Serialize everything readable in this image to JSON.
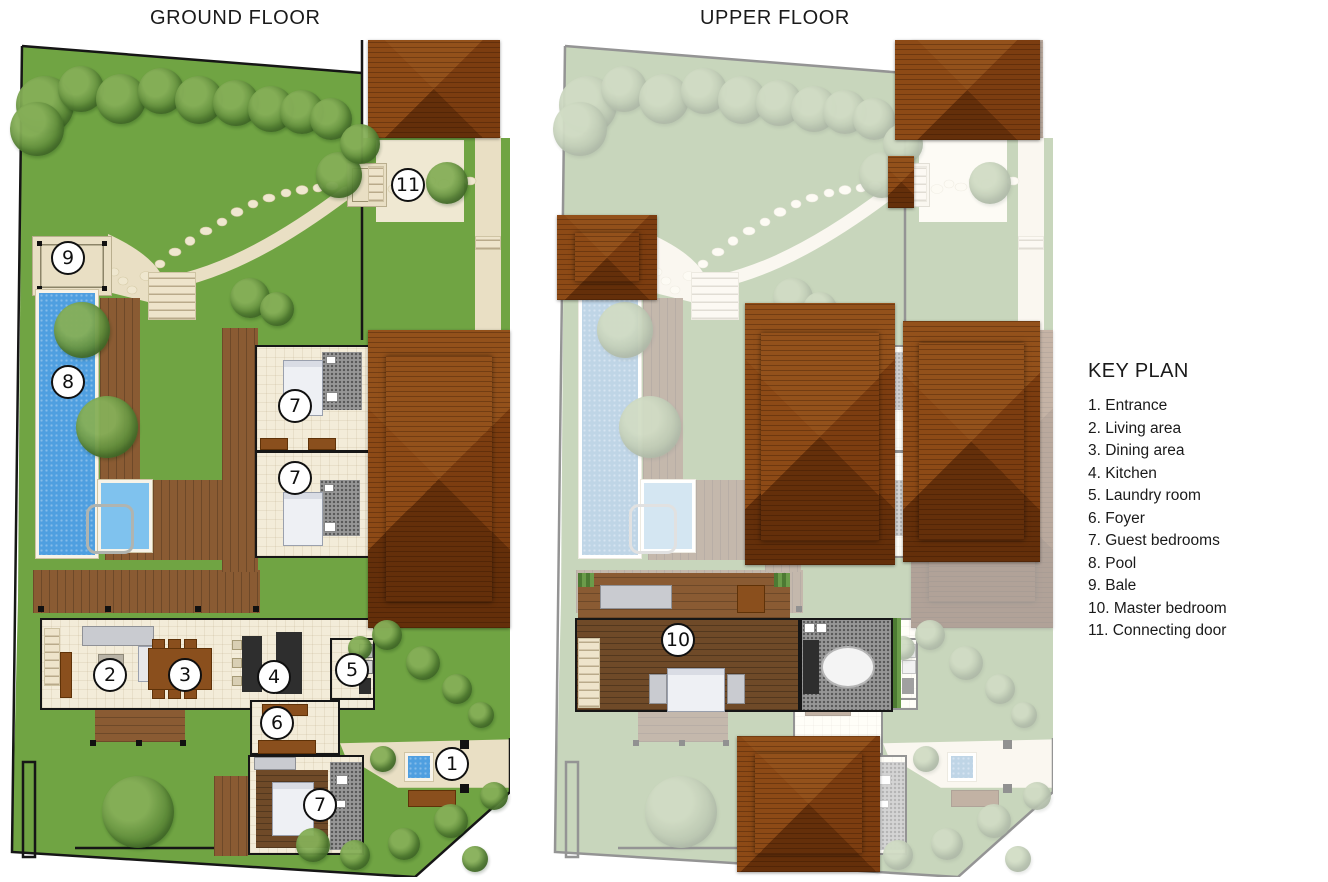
{
  "header": {
    "ground_title": "GROUND FLOOR",
    "upper_title": "UPPER FLOOR"
  },
  "keyplan": {
    "title": "KEY PLAN",
    "items": [
      "1. Entrance",
      "2. Living area",
      "3. Dining area",
      "4. Kitchen",
      "5. Laundry room",
      "6. Foyer",
      "7. Guest bedrooms",
      "8. Pool",
      "9. Bale",
      "10. Master bedroom",
      "11. Connecting door"
    ]
  },
  "markers": {
    "ground": [
      {
        "n": "11",
        "label": "Connecting door",
        "x": 398,
        "y": 145
      },
      {
        "n": "9",
        "label": "Bale",
        "x": 58,
        "y": 218
      },
      {
        "n": "8",
        "label": "Pool",
        "x": 58,
        "y": 342
      },
      {
        "n": "7",
        "label": "Guest bedroom",
        "x": 285,
        "y": 366
      },
      {
        "n": "7",
        "label": "Guest bedroom",
        "x": 285,
        "y": 438
      },
      {
        "n": "2",
        "label": "Living area",
        "x": 100,
        "y": 635
      },
      {
        "n": "3",
        "label": "Dining area",
        "x": 175,
        "y": 635
      },
      {
        "n": "4",
        "label": "Kitchen",
        "x": 264,
        "y": 637
      },
      {
        "n": "5",
        "label": "Laundry room",
        "x": 342,
        "y": 630
      },
      {
        "n": "6",
        "label": "Foyer",
        "x": 267,
        "y": 683
      },
      {
        "n": "1",
        "label": "Entrance",
        "x": 442,
        "y": 724
      },
      {
        "n": "7",
        "label": "Guest bedroom",
        "x": 310,
        "y": 765
      }
    ],
    "upper": [
      {
        "n": "10",
        "label": "Master bedroom",
        "x": 125,
        "y": 600
      }
    ]
  },
  "colors": {
    "grass": "#70a443",
    "path": "#e9dfc4",
    "cream": "#f3ecd9",
    "pool": "#4f9fe0",
    "roof_light": "#93511b",
    "roof_mid": "#7c3d10",
    "roof_dark": "#642f0a",
    "deck": "#8a5b33",
    "dark_wood": "#6f4a28",
    "stone": "#979797",
    "wall": "#161616",
    "marker_border": "#101010",
    "text": "#1a1a1a"
  }
}
